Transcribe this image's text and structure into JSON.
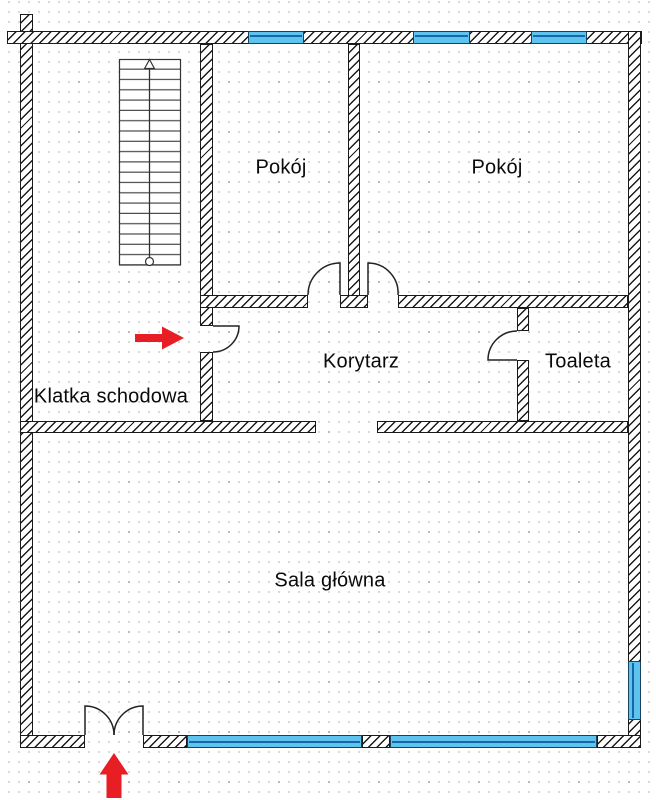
{
  "plan": {
    "rooms": [
      {
        "id": "pokoj-1",
        "label": "Pokój"
      },
      {
        "id": "pokoj-2",
        "label": "Pokój"
      },
      {
        "id": "korytarz",
        "label": "Korytarz"
      },
      {
        "id": "toaleta",
        "label": "Toaleta"
      },
      {
        "id": "klatka-schodowa",
        "label": "Klatka schodowa"
      },
      {
        "id": "sala-glowna",
        "label": "Sala główna"
      }
    ],
    "symbols": {
      "staircase": "staircase-with-up-direction-line",
      "entrance_main": "red-arrow-up-at-double-entry-door",
      "entrance_side": "red-arrow-right-at-staircase-door",
      "window": "blue-double-line-window",
      "door": "quarter-arc-swing-door"
    },
    "window_count": 6,
    "door_count": 5
  },
  "colors": {
    "background": "#ffffff",
    "grid_dot": "#cdcdcd",
    "grid_dot_strong": "#b5b5b5",
    "wall_line": "#1a1a1a",
    "window_fill": "#5ec3ee",
    "window_line": "#1669a5",
    "window_frame": "#16425f",
    "arrow_red": "#e81e25"
  }
}
